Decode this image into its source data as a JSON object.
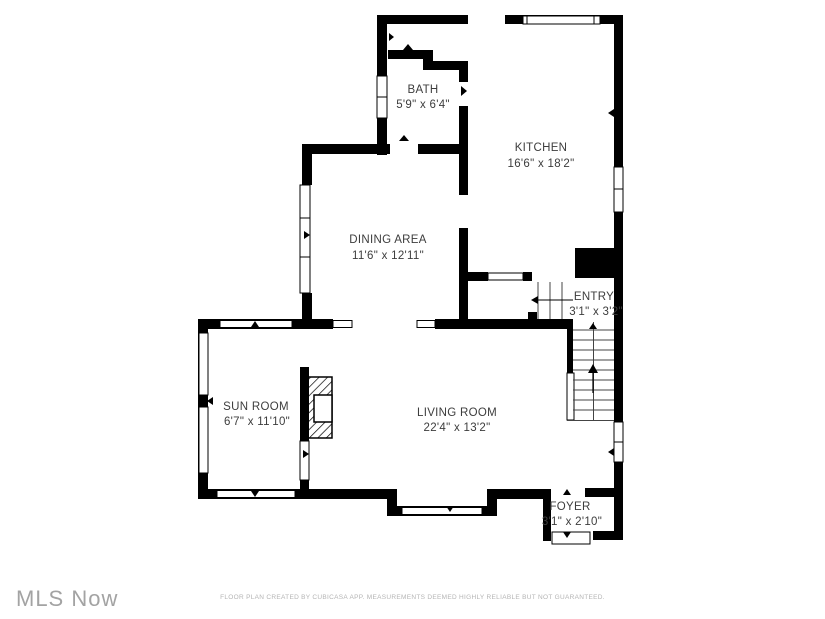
{
  "rooms": {
    "bath": {
      "name": "BATH",
      "dims": "5'9\" x 6'4\""
    },
    "kitchen": {
      "name": "KITCHEN",
      "dims": "16'6\" x 18'2\""
    },
    "dining": {
      "name": "DINING AREA",
      "dims": "11'6\" x 12'11\""
    },
    "entry": {
      "name": "ENTRY",
      "dims": "3'1\" x 3'2\""
    },
    "sunroom": {
      "name": "SUN ROOM",
      "dims": "6'7\" x 11'10\""
    },
    "living": {
      "name": "LIVING ROOM",
      "dims": "22'4\" x 13'2\""
    },
    "foyer": {
      "name": "FOYER",
      "dims": "3'1\" x 2'10\""
    }
  },
  "footer": {
    "logo": "MLS Now",
    "disclaimer": "FLOOR PLAN CREATED BY CUBICASA APP. MEASUREMENTS DEEMED HIGHLY RELIABLE BUT NOT GUARANTEED."
  },
  "colors": {
    "wall": "#000000",
    "background": "#ffffff",
    "label_text": "#3d3d3d",
    "logo_gray": "#a3a3a3",
    "disclaimer_gray": "#b4b4b4"
  }
}
